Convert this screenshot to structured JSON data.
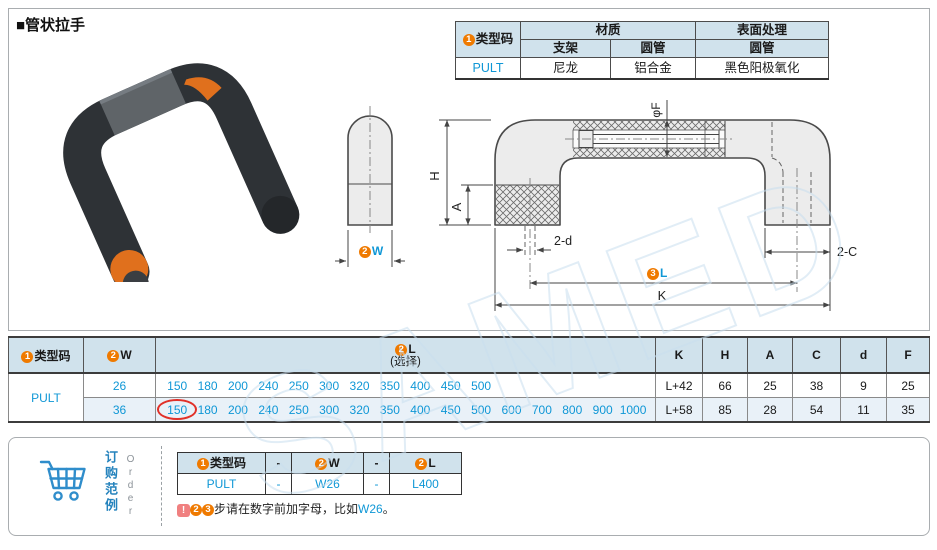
{
  "title": "■管状拉手",
  "colors": {
    "accent_blue": "#0f97d6",
    "badge_orange": "#ef7a00",
    "header_bg": "#d0e2ec",
    "highlight_red": "#e13028",
    "product_orange": "#e0701d"
  },
  "spec_table": {
    "type_header": {
      "badge": "1",
      "label": "类型码"
    },
    "material_header": "材质",
    "surface_header": "表面处理",
    "sub_headers": {
      "bracket": "支架",
      "tube": "圆管",
      "surface_tube": "圆管"
    },
    "row": {
      "type": "PULT",
      "bracket": "尼龙",
      "tube": "铝合金",
      "surface": "黑色阳极氧化"
    }
  },
  "drawing": {
    "watermark": "SAMED",
    "labels": {
      "h": "H",
      "a": "A",
      "f": "φF",
      "two_d": "2-d",
      "two_c": "2-C",
      "k": "K",
      "w_badge": "2",
      "w": "W",
      "l_badge": "3",
      "l": "L"
    }
  },
  "main_table": {
    "headers": {
      "type": {
        "badge": "1",
        "label": "类型码"
      },
      "w": {
        "badge": "2",
        "label": "W"
      },
      "l": {
        "badge": "2",
        "label": "L",
        "note": "(选择)"
      },
      "k": "K",
      "h": "H",
      "a": "A",
      "c": "C",
      "d": "d",
      "f": "F"
    },
    "type_value": "PULT",
    "rows": [
      {
        "w": "26",
        "l_values": [
          "150",
          "180",
          "200",
          "240",
          "250",
          "300",
          "320",
          "350",
          "400",
          "450",
          "500"
        ],
        "k": "L+42",
        "h": "66",
        "a": "25",
        "c": "38",
        "d": "9",
        "f": "25"
      },
      {
        "w": "36",
        "l_values": [
          "150",
          "180",
          "200",
          "240",
          "250",
          "300",
          "320",
          "350",
          "400",
          "450",
          "500",
          "600",
          "700",
          "800",
          "900",
          "1000"
        ],
        "circled_l_value": "150",
        "k": "L+58",
        "h": "85",
        "a": "28",
        "c": "54",
        "d": "11",
        "f": "35"
      }
    ]
  },
  "order": {
    "label_cn": "订购范例",
    "label_en": "Order",
    "table": {
      "headers": [
        {
          "badge": "1",
          "label": "类型码"
        },
        {
          "label": "-"
        },
        {
          "badge": "2",
          "label": "W"
        },
        {
          "label": "-"
        },
        {
          "badge": "2",
          "label": "L"
        }
      ],
      "values": [
        "PULT",
        "-",
        "W26",
        "-",
        "L400"
      ]
    },
    "note": {
      "icon": "!",
      "badges": [
        "2",
        "3"
      ],
      "text": "步请在数字前加字母，比如",
      "code": "W26",
      "period": "。"
    }
  }
}
